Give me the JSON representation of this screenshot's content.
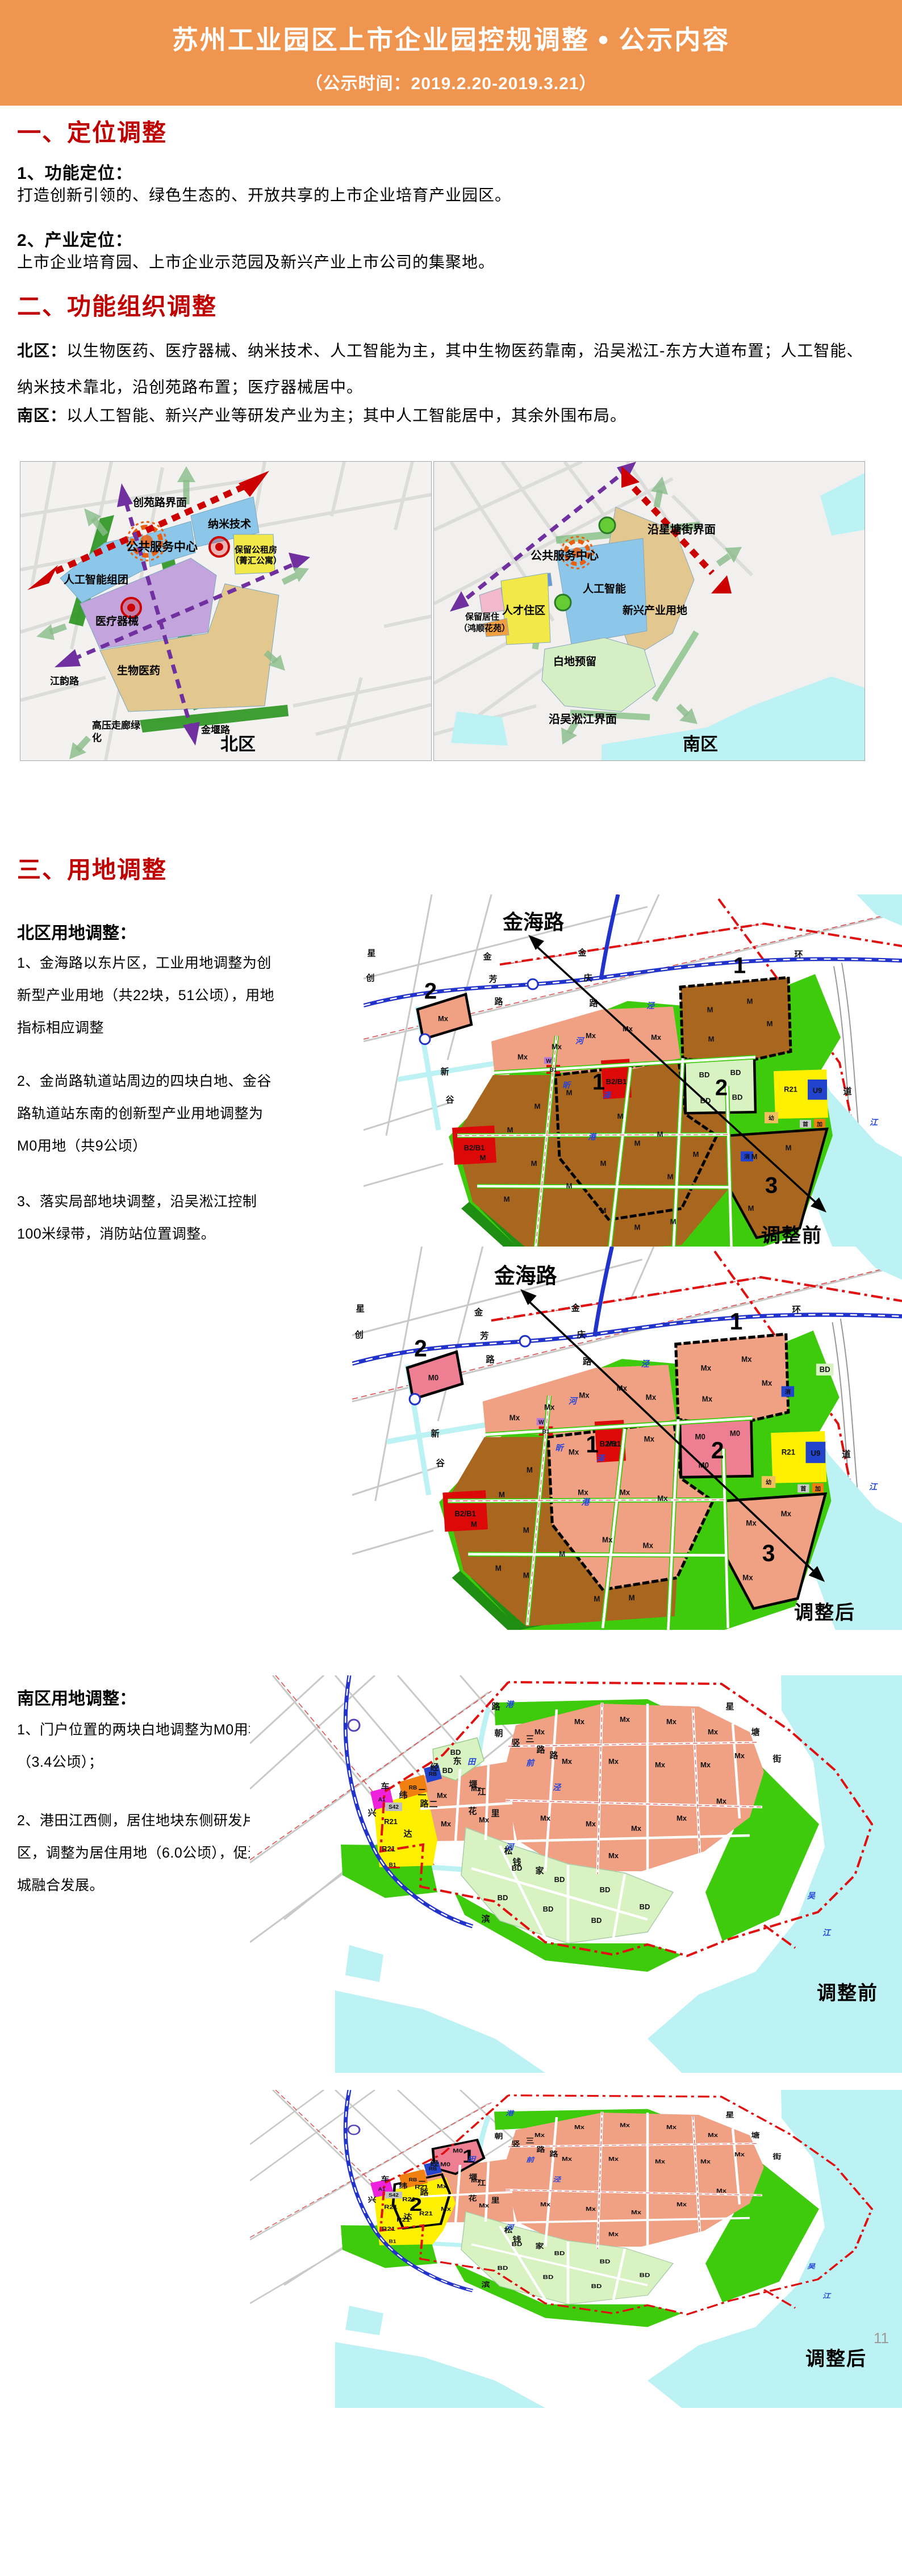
{
  "colors": {
    "header_bg": "#F0954F",
    "heading_red": "#C00000",
    "m_brown": "#A8661F",
    "mx_salmon": "#F0A183",
    "m0_pink": "#EE7F92",
    "bd_green": "#D9F2C2",
    "bright_green": "#3ECB0C",
    "dark_green": "#1E8F12",
    "water_cyan": "#BDF2F4",
    "r21_yellow": "#FFF000",
    "red_block": "#DD0808",
    "blue_block": "#2244CC",
    "magenta_block": "#EE22DD",
    "orange_block": "#F08010",
    "metro_blue": "#2233CC",
    "boundary_red": "#E01010",
    "purple_arrow": "#7030A0",
    "red_arrow": "#CC0000",
    "ov_blue": "#8CC6E8",
    "ov_purple": "#C4A4DC",
    "ov_tan": "#E2C78E",
    "ov_yellow": "#F2E948",
    "ov_lgreen": "#D6EEC4",
    "ov_pink": "#F2B8CC"
  },
  "header": {
    "title": "苏州工业园区上市企业园控规调整",
    "bullet": "●",
    "suffix": "公示内容",
    "subtitle": "（公示时间：2019.2.20-2019.3.21）"
  },
  "section_one": {
    "heading": "一、定位调整",
    "item1_title": "1、功能定位：",
    "item1_body": "打造创新引领的、绿色生态的、开放共享的上市企业培育产业园区。",
    "item2_title": "2、产业定位：",
    "item2_body": "上市企业培育园、上市企业示范园及新兴产业上市公司的集聚地。"
  },
  "section_two": {
    "heading": "二、功能组织调整",
    "north_label": "北区：",
    "north_body": "以生物医药、医疗器械、纳米技术、人工智能为主，其中生物医药靠南，沿吴淞江-东方大道布置；人工智能、纳米技术靠北，沿创苑路布置；医疗器械居中。",
    "south_label": "南区：",
    "south_body": "以人工智能、新兴产业等研发产业为主；其中人工智能居中，其余外围布局。"
  },
  "overview": {
    "north": {
      "corridor": "创苑路界面",
      "nano": "纳米技术",
      "center": "公共服务中心",
      "rent1": "保留公租房",
      "rent2": "（菁汇公寓）",
      "ai": "人工智能组团",
      "medical": "医疗器械",
      "bio": "生物医药",
      "jiangyun": "江韵路",
      "hv1": "高压走廊绿",
      "hv2": "化",
      "jinyan": "金堰路",
      "region": "北区"
    },
    "south": {
      "corridor": "沿星塘街界面",
      "center": "公共服务中心",
      "ai": "人工智能",
      "newind": "新兴产业用地",
      "talent": "人才住区",
      "keep1": "保留居住",
      "keep2": "（鸿顺花苑）",
      "white": "白地预留",
      "river": "沿吴淞江界面",
      "region": "南区"
    }
  },
  "section_three": {
    "heading": "三、用地调整",
    "north_title": "北区用地调整：",
    "north_items": [
      "1、金海路以东片区，工业用地调整为创新型产业用地（共22块，51公顷），用地指标相应调整",
      "2、金尚路轨道站周边的四块白地、金谷路轨道站东南的创新型产业用地调整为M0用地（共9公顷）",
      "3、落实局部地块调整，沿吴淞江控制100米绿带，消防站位置调整。"
    ],
    "south_title": "南区用地调整：",
    "south_items": [
      "1、门户位置的两块白地调整为M0用地（3.4公顷）；",
      "2、港田江西侧，居住地块东侧研发片区，调整为居住用地（6.0公顷），促进产城融合发展。"
    ]
  },
  "detail": {
    "before": "调整前",
    "after": "调整后",
    "jinhai": "金海路",
    "n1": "1",
    "n2": "2",
    "n3": "3"
  },
  "codes": {
    "M": "M",
    "Mx": "Mx",
    "M0": "M0",
    "BD": "BD",
    "R21": "R21",
    "B2B1": "B2/B1",
    "B1": "B1",
    "U9": "U9",
    "A1": "A1",
    "RB": "RB",
    "S42": "S42",
    "you": "幼",
    "jia": "加",
    "shou": "首",
    "xiao": "消",
    "W": "W"
  },
  "north_chars": {
    "jin": "金",
    "fang": "芳",
    "qing": "庆",
    "lu": "路",
    "jing": "泾",
    "he": "河",
    "huan": "环",
    "jiang": "江",
    "dao": "道",
    "xing": "星",
    "chuang": "创",
    "xin": "新",
    "gu": "谷",
    "xinx": "昕",
    "ze": "泽",
    "gang": "港"
  },
  "south_chars": {
    "xing": "星",
    "tang": "塘",
    "jie": "街",
    "chao": "朝",
    "qian": "前",
    "lu": "路",
    "shu": "竖",
    "san": "三",
    "yan": "堰",
    "jiang": "江",
    "hua": "花",
    "li": "里",
    "gang": "港",
    "tian": "田",
    "jing": "泾",
    "he": "河",
    "wu": "吴",
    "song": "松",
    "bin": "滨",
    "qianj": "钱",
    "jia": "家",
    "wei": "纬",
    "er": "二",
    "jingr": "经",
    "da": "达",
    "xingx": "兴",
    "che": "车",
    "dong": "东"
  },
  "page_number": "11"
}
